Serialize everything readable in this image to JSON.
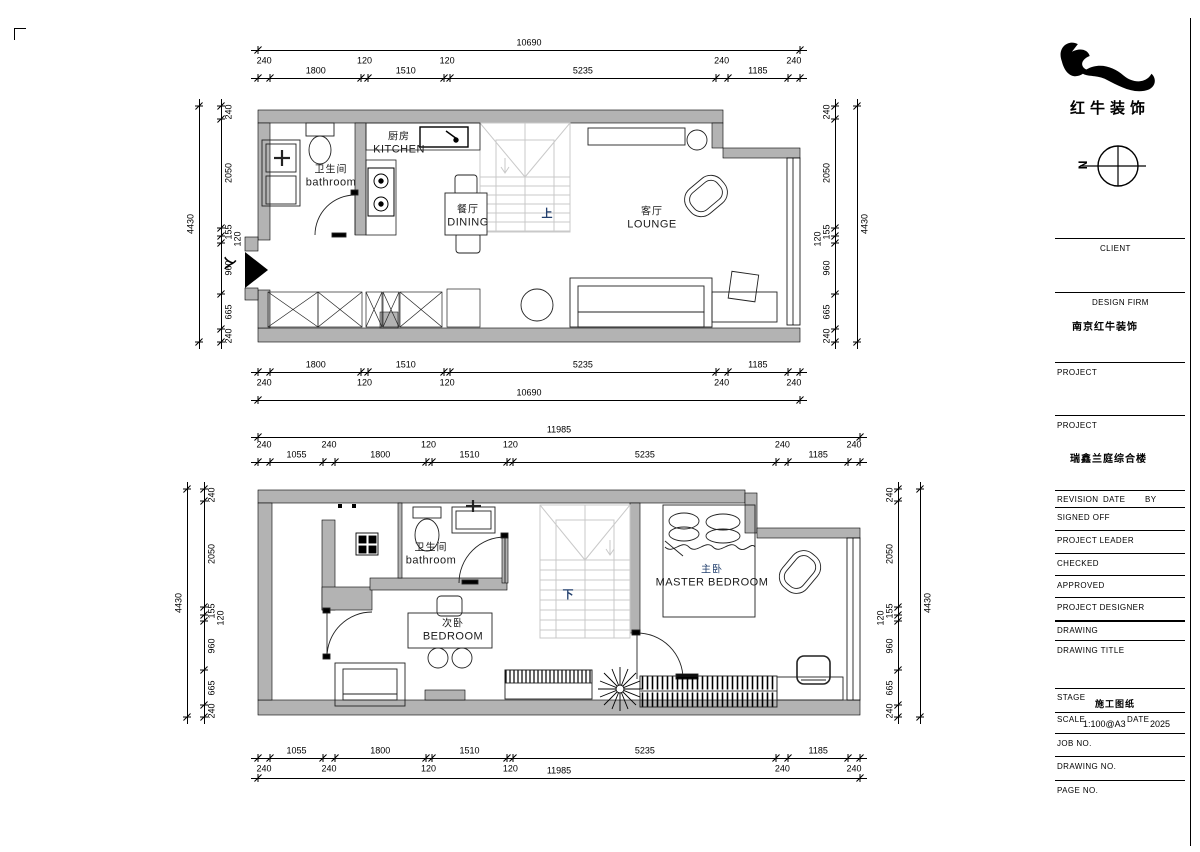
{
  "sheet": {
    "bg": "#ffffff",
    "line_color": "#000000",
    "wall_fill": "#b3b3b3",
    "stair_line_color": "#c9c9c9",
    "accent_blue": "#23406e"
  },
  "plans": {
    "upper": {
      "rooms": {
        "bathroom": {
          "cn": "卫生间",
          "en": "bathroom"
        },
        "kitchen": {
          "cn": "厨房",
          "en": "KITCHEN"
        },
        "dining": {
          "cn": "餐厅",
          "en": "DINING"
        },
        "lounge": {
          "cn": "客厅",
          "en": "LOUNGE"
        }
      },
      "stair_label": "上",
      "entry_label": "入"
    },
    "lower": {
      "rooms": {
        "bathroom": {
          "cn": "卫生间",
          "en": "bathroom"
        },
        "bedroom": {
          "cn": "次卧",
          "en": "BEDROOM"
        },
        "master": {
          "cn": "主卧",
          "en": "MASTER BEDROOM"
        }
      },
      "stair_label": "下"
    }
  },
  "dimensions": {
    "chains": [
      {
        "id": "plan1-top",
        "overall": 10690,
        "segments": [
          240,
          1800,
          120,
          1510,
          120,
          5235,
          240,
          1185,
          240
        ]
      },
      {
        "id": "plan1-bottom",
        "overall": 10690,
        "segments": [
          240,
          1800,
          120,
          1510,
          120,
          5235,
          240,
          1185,
          240
        ]
      },
      {
        "id": "plan1-left",
        "overall": 4430,
        "segments": [
          240,
          2050,
          155,
          120,
          960,
          665,
          240
        ]
      },
      {
        "id": "plan1-right",
        "overall": 4430,
        "segments": [
          240,
          2050,
          155,
          120,
          960,
          665,
          240
        ]
      },
      {
        "id": "plan2-top",
        "overall": 11985,
        "segments": [
          240,
          1055,
          240,
          1800,
          120,
          1510,
          120,
          5235,
          240,
          1185,
          240
        ]
      },
      {
        "id": "plan2-bottom",
        "overall": 11985,
        "segments": [
          240,
          1055,
          240,
          1800,
          120,
          1510,
          120,
          5235,
          240,
          1185,
          240
        ]
      },
      {
        "id": "plan2-left",
        "overall": 4430,
        "segments": [
          240,
          2050,
          155,
          120,
          960,
          665,
          240
        ]
      },
      {
        "id": "plan2-right",
        "overall": 4430,
        "segments": [
          240,
          2050,
          155,
          120,
          960,
          665,
          240
        ]
      }
    ]
  },
  "title_block": {
    "logo_text": "红牛装饰",
    "north_label": "N",
    "client": "CLIENT",
    "design_firm_label": "DESIGN FIRM",
    "design_firm_value": "南京红牛装饰",
    "project1_label": "PROJECT",
    "project2_label": "PROJECT",
    "project_value": "瑞鑫兰庭综合楼",
    "revision_label": "REVISION",
    "date_col_label": "DATE",
    "by_label": "BY",
    "signed_off": "SIGNED OFF",
    "project_leader": "PROJECT LEADER",
    "checked": "CHECKED",
    "approved": "APPROVED",
    "project_designer": "PROJECT DESIGNER",
    "drawing": "DRAWING",
    "drawing_title": "DRAWING TITLE",
    "stage_label": "STAGE",
    "stage_value": "施工图纸",
    "scale_label": "SCALE",
    "scale_value": "1:100@A3",
    "date_label": "DATE",
    "date_value": "2025",
    "job_no": "JOB NO.",
    "drawing_no": "DRAWING NO.",
    "page_no": "PAGE NO."
  }
}
